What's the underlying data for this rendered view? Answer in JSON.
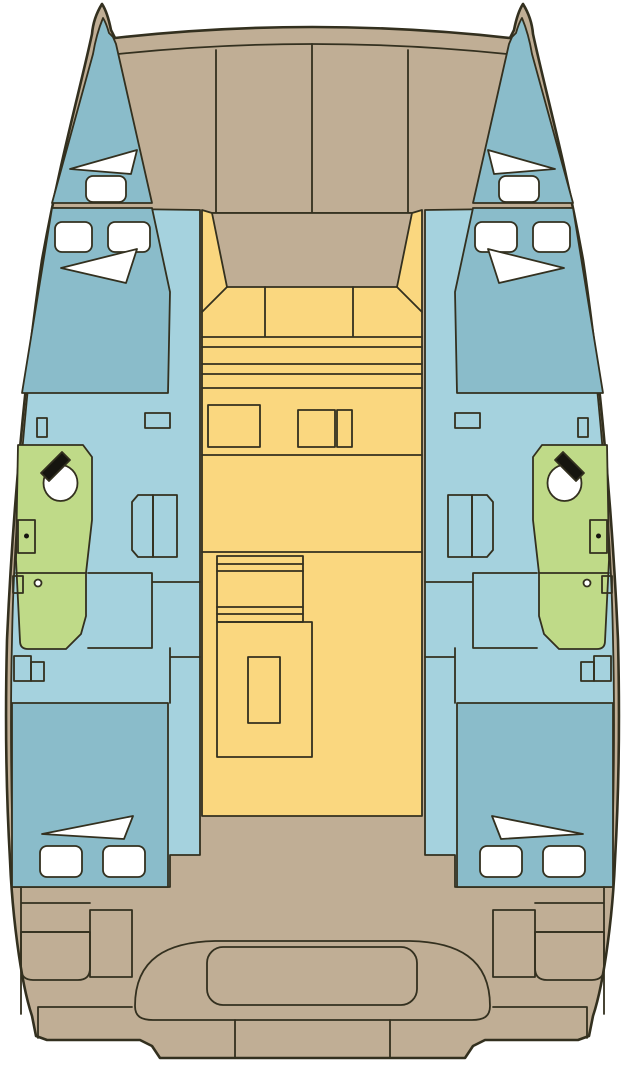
{
  "figure": {
    "type": "boat-deck-floor-plan",
    "subject": "catamaran yacht layout, top view, bow up",
    "symmetry": "port-starboard mirrored"
  },
  "palette": {
    "background": "#ffffff",
    "outline": "#33301f",
    "deck": "#c0ae95",
    "hull_room": "#8abcca",
    "hull_floor": "#a5d2de",
    "salon": "#fad77f",
    "head": "#bfda88",
    "hatch": "#ffffff",
    "fixture_dark": "#16150f"
  },
  "areas": {
    "foredeck": {
      "label": "foredeck with panel seams",
      "fill": "deck",
      "panel_seams": 3
    },
    "windscreen": {
      "label": "coachroof windscreen",
      "fill": "deck"
    },
    "salon": {
      "label": "salon / saloon sole",
      "fill": "salon"
    },
    "forward_bench": {
      "label": "forward cockpit bench, 3 seats",
      "fill": "salon",
      "seat_count": 3
    },
    "galley": {
      "label": "galley counters",
      "fill": "salon",
      "units": 3
    },
    "settee": {
      "label": "settee",
      "fill": "salon"
    },
    "salon_table": {
      "label": "salon table",
      "fill": "salon"
    },
    "port_bow_cabin": {
      "label": "port bow stowage",
      "fill": "hull_room",
      "hatches": {
        "triangle": 1,
        "rounded": 1
      }
    },
    "port_forward_cabin": {
      "label": "port forward cabin berth",
      "fill": "hull_room",
      "hatches": {
        "triangle": 1,
        "rounded": 2
      }
    },
    "port_head": {
      "label": "port head / bathroom",
      "fill": "head",
      "fixtures": [
        "basin",
        "faucet",
        "toilet",
        "drain"
      ]
    },
    "port_wardrobe": {
      "label": "port wardrobe / dresser",
      "fill": "hull_floor"
    },
    "port_companionway": {
      "label": "port companionway steps",
      "fill": "hull_floor"
    },
    "port_aft_cabin": {
      "label": "port aft cabin berth",
      "fill": "hull_room",
      "hatches": {
        "triangle": 1,
        "rounded": 2
      }
    },
    "starboard_side": {
      "label": "starboard hull, mirror of port hull",
      "fill": "hull_room"
    },
    "cockpit": {
      "label": "aft cockpit",
      "fill": "deck"
    },
    "cockpit_bench": {
      "label": "aft cockpit bench with cushion",
      "fill": "deck"
    },
    "stern_lockers": {
      "label": "aft deck lockers",
      "fill": "deck"
    },
    "swim_platform": {
      "label": "transom steps",
      "fill": "deck"
    }
  }
}
